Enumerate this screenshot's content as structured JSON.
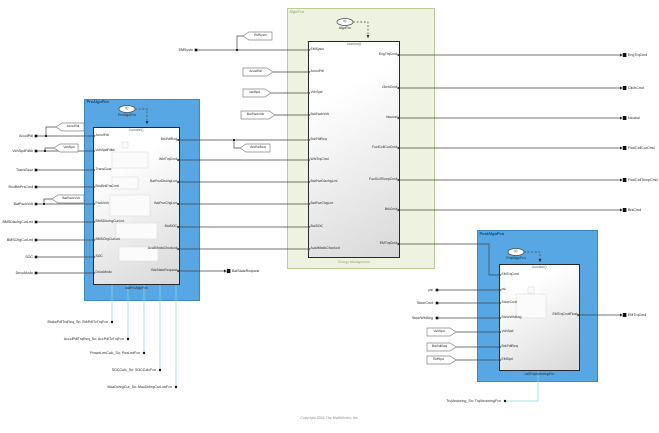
{
  "copyright": "Copyright 2024 The MathWorks, Inc.",
  "pre_algo": {
    "label": "PreAlgoFcn",
    "icon_text": "f()",
    "icon_caption": "PreAlgoFcn",
    "header": "function()",
    "footer": "callPreAlgoFcn",
    "inputs": [
      "AccelPdl",
      "VehSpdFdbk",
      "TransGear",
      "BcuBrkPrsCmd",
      "PackVolt",
      "BMSDischgCurLmt",
      "BMSChgCurLmt",
      "SOC",
      "DriveMode"
    ],
    "external_inputs": [
      "AccelPdl",
      "VehSpdFdbk",
      "TransGear",
      "BcuBrkPrsCmd",
      "BatPackVolt",
      "BMSDischgCurLmt",
      "BMSChgCurLmt",
      "SOC",
      "DriveMode"
    ],
    "outputs": [
      "BrkPdlReq",
      "WhlTrqCmd",
      "BatPwrDischgLmt",
      "BatPwrChgLmt",
      "BatSOC",
      "AvailModeChecked",
      "BatStateRequest"
    ],
    "tags": {
      "accel": "AccelPdl",
      "vehspd": "VehSpd",
      "batpack": "BatPackVolt",
      "brk": "BrkPdlReq"
    },
    "out_port_label": "BatStateRequest",
    "sn_annotations": [
      "BrakePdlTrqReq_Sn: BrkPdlToTrqFcn",
      "AccelPdlTrqReq_Sn: AccPdlToTrqFcn",
      "PowerLmtCalc_Sn: PwrLmtFcn",
      "SOCCalc_Sn: SOCCalcFcn",
      "MaxDchrgCur_Sn: MaxDchrgCurLimFcn"
    ]
  },
  "algo": {
    "label": "AlgoFcn",
    "icon_text": "f()",
    "icon_caption": "AlgoFcn",
    "header": "function()",
    "footer": "Energy Management",
    "external_input": "EMSysIn",
    "goto_tag": "EMSysIn",
    "from_tags": {
      "accel": "AccelPdl",
      "vehspd": "VehSpd",
      "batpack": "BatPackVolt"
    },
    "inputs": [
      "EMSysIn",
      "AccelPdl",
      "VehSpd",
      "BatPackVolt",
      "BrkPdlReq",
      "WhlTrqCmd",
      "BatPwrDischgLmt",
      "BatPwrChgLmt",
      "BatSOC",
      "AvailModeChecked"
    ],
    "outputs": [
      "EngTrqCmd",
      "CltchCmd",
      "Neutral",
      "FuelCellCurCmd",
      "FuelCellTempCmd",
      "BrkCmd",
      "EMTrqCmd"
    ],
    "external_outputs": [
      "EngTrqCmd",
      "CltchCmd",
      "Neutral",
      "FuelCellCurCmd",
      "FuelCellTempCmd",
      "BrkCmd"
    ]
  },
  "post_algo": {
    "label": "PostAlgoFcn",
    "icon_text": "f()",
    "icon_caption": "PostAlgoFcn",
    "header": "function()",
    "footer": "callTrqVectoringFcn",
    "inputs": [
      "EMTrqCmd",
      "psi",
      "SteerCmd",
      "SteerWhlAng",
      "VehSpd",
      "BrkPdlReq",
      "EMSpd"
    ],
    "external_inputs": [
      "psi",
      "SteerCmd",
      "SteerWhlAng"
    ],
    "from_tags": {
      "vehspd": "VehSpd",
      "brk": "BrkPdlReq",
      "emspd": "EMSpd"
    },
    "output": "EMTrqCmdFinal",
    "external_output": "EMTrqCmd",
    "sn_annotation": "TrqVectoring_Sn: TrqVectoringFcn"
  }
}
